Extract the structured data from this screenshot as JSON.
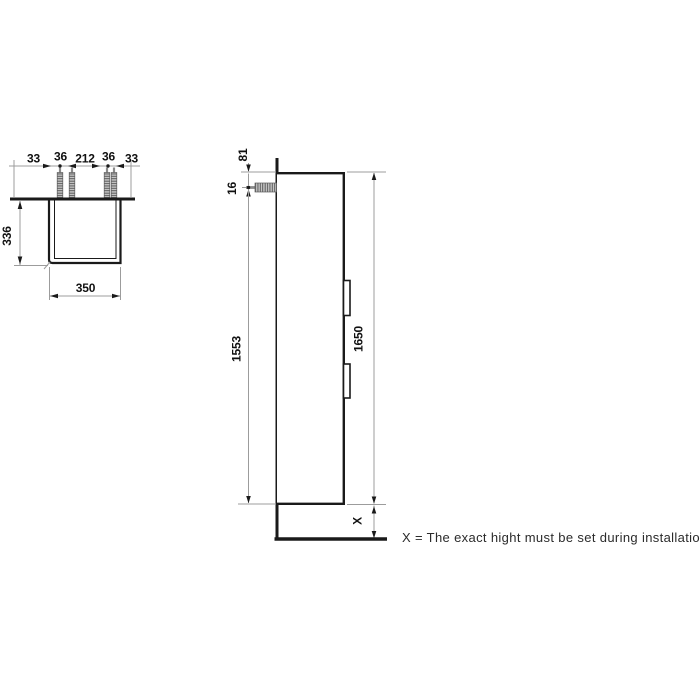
{
  "drawing": {
    "colors": {
      "object_line": "#1a1a1a",
      "dimension_line": "#9c9c9c",
      "hatch_fill": "#c9c9c9",
      "text": "#111111"
    },
    "plan_view": {
      "dims_top": [
        "33",
        "36",
        "212",
        "36",
        "33"
      ],
      "dim_depth": "336",
      "dim_width": "350"
    },
    "side_view": {
      "dim_rail_top": "81",
      "dim_screw_offset": "16",
      "dim_screw_to_bottom": "1553",
      "dim_total_height": "1650",
      "dim_floor_gap": "X"
    },
    "caption": "X = The exact hight must be set during installation."
  }
}
